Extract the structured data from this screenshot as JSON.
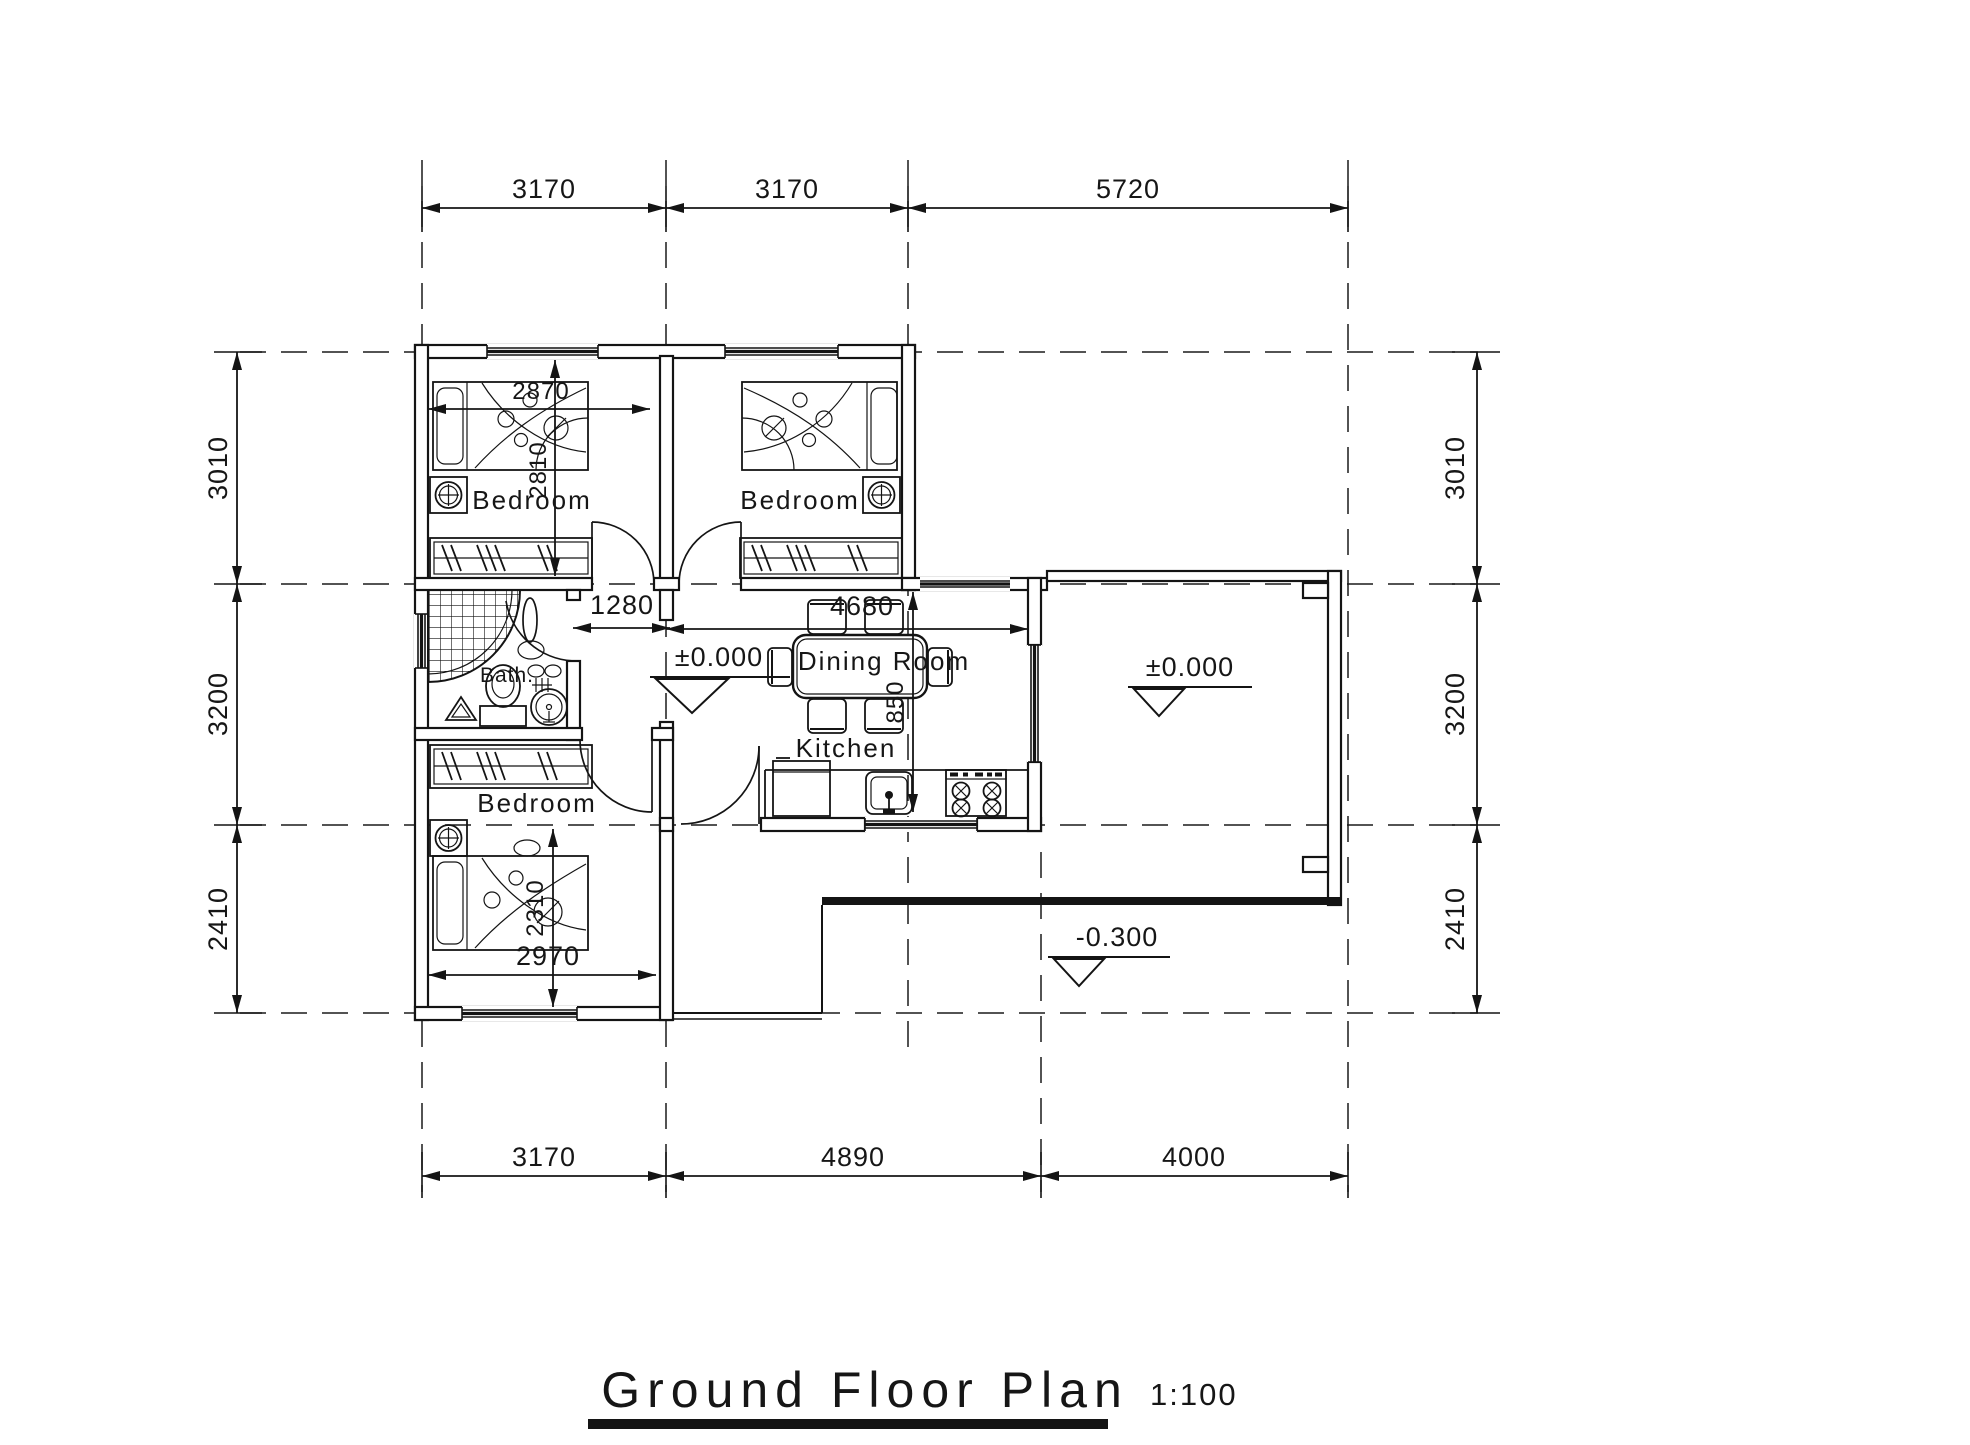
{
  "title": {
    "text": "Ground Floor Plan",
    "scale": "1:100"
  },
  "dimensions": {
    "top": [
      "3170",
      "3170",
      "5720"
    ],
    "bottom": [
      "3170",
      "4890",
      "4000"
    ],
    "left": [
      "3010",
      "3200",
      "2410"
    ],
    "right": [
      "3010",
      "3200",
      "2410"
    ],
    "interior": {
      "bedroom1_width": "2870",
      "bedroom1_depth": "2810",
      "hall_width": "1280",
      "dining_width": "4680",
      "dining_depth": "850",
      "bedroom3_width": "2970",
      "bedroom3_depth": "2310"
    }
  },
  "levels": {
    "hall": "±0.000",
    "terrace": "±0.000",
    "yard": "-0.300"
  },
  "rooms": {
    "bedroom1": "Bedroom",
    "bedroom2": "Bedroom",
    "bedroom3": "Bedroom",
    "bath": "Bath.",
    "dining": "Dining Room",
    "kitchen": "Kitchen"
  }
}
